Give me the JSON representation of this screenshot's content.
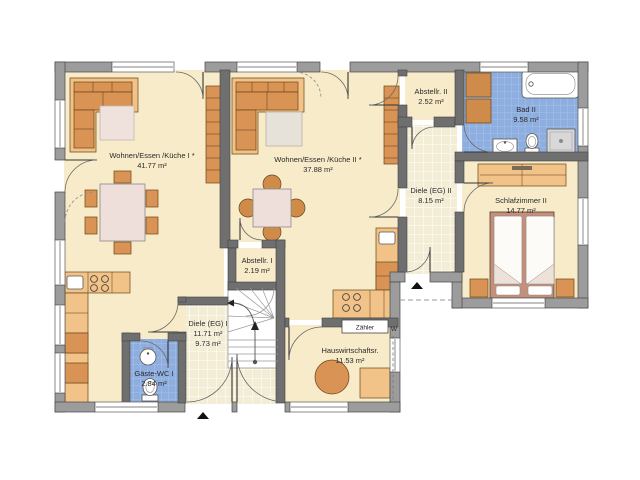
{
  "plan_title": "Erdgeschoss Grundriss",
  "palette": {
    "floor": "#F7EBC9",
    "hall_tile": "#F3EDD6",
    "bath_tile": "#8FAEE0",
    "wall_exterior": "#9C9C9C",
    "wall_interior": "#6F6F6F",
    "furniture_light": "#F2C389",
    "furniture_mid": "#D89355",
    "furniture_dark": "#CE8B49",
    "rug": "#EFE2DC"
  },
  "rooms": [
    {
      "name": "Wohnen/Essen /Küche I *",
      "area": "41.77 m²"
    },
    {
      "name": "Wohnen/Essen /Küche II *",
      "area": "37.88 m²"
    },
    {
      "name": "Abstellr. II",
      "area": "2.52 m²"
    },
    {
      "name": "Bad II",
      "area": "9.58 m²"
    },
    {
      "name": "Diele (EG) II",
      "area": "8.15 m²"
    },
    {
      "name": "Schlafzimmer II",
      "area": "14.77 m²"
    },
    {
      "name": "Abstellr. I",
      "area": "2.19 m²"
    },
    {
      "name": "Diele (EG) I",
      "area": "11.71 m²",
      "area2": "9.73 m²"
    },
    {
      "name": "Gäste-WC I",
      "area": "2.84 m²"
    },
    {
      "name": "Hauswirtschaftsr.",
      "area": "11.53 m²"
    }
  ],
  "annotations": {
    "meter": "Zähler",
    "wall_mark": "W"
  }
}
